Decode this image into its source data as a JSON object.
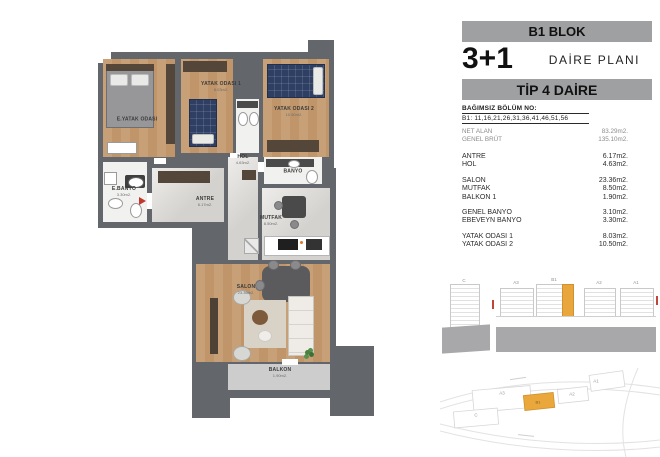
{
  "header": {
    "block_title": "B1 BLOK",
    "plan_type": "3+1",
    "plan_type_label": "DAİRE PLANI",
    "unit_type": "TİP 4 DAİRE",
    "section_label": "BAĞIMSIZ BÖLÜM NO:",
    "section_numbers": "B1: 11,16,21,26,31,36,41,46,51,56"
  },
  "area_table": {
    "summary": [
      {
        "label": "NET ALAN",
        "value": "83.29m2."
      },
      {
        "label": "GENEL BRÜT",
        "value": "135.10m2."
      }
    ],
    "groups": [
      [
        {
          "label": "ANTRE",
          "value": "6.17m2."
        },
        {
          "label": "HOL",
          "value": "4.63m2."
        }
      ],
      [
        {
          "label": "SALON",
          "value": "23.36m2."
        },
        {
          "label": "MUTFAK",
          "value": "8.50m2."
        },
        {
          "label": "BALKON 1",
          "value": "1.90m2."
        }
      ],
      [
        {
          "label": "GENEL BANYO",
          "value": "3.10m2."
        },
        {
          "label": "EBEVEYN BANYO",
          "value": "3.30m2."
        }
      ],
      [
        {
          "label": "YATAK ODASI 1",
          "value": "8.03m2."
        },
        {
          "label": "YATAK ODASI 2",
          "value": "10.50m2."
        }
      ]
    ]
  },
  "floor_plan": {
    "rooms": {
      "master_bedroom": {
        "label": "E.YATAK ODASI"
      },
      "bedroom1": {
        "label": "YATAK ODASI 1",
        "area": "8.03m2."
      },
      "bedroom2": {
        "label": "YATAK ODASI 2",
        "area": "10.50m2."
      },
      "master_bath": {
        "label": "E.BANYO",
        "area": "3.30m2."
      },
      "bath": {
        "label": "BANYO",
        "area": "3.10m2."
      },
      "hall": {
        "label": "HOL",
        "area": "4.63m2."
      },
      "entry": {
        "label": "ANTRE",
        "area": "6.17m2."
      },
      "kitchen": {
        "label": "MUTFAK",
        "area": "8.50m2."
      },
      "living": {
        "label": "SALON",
        "area": "23.36m2."
      },
      "balcony": {
        "label": "BALKON",
        "area": "1.90m2."
      }
    }
  },
  "elevation": {
    "detached_tower": "C",
    "towers": [
      "A3",
      "B1",
      "A2",
      "A1"
    ],
    "highlighted_tower": "B1"
  },
  "site_plan": {
    "parcels": {
      "a3": "A3",
      "b1": "B1",
      "a2": "A2",
      "a1": "A1",
      "c": "C"
    },
    "highlighted_parcel": "B1"
  },
  "colors": {
    "header_bar": "#9fa0a2",
    "wall": "#63666a",
    "wood_floor": "#c7a077",
    "highlight_orange": "#e8a63c"
  }
}
